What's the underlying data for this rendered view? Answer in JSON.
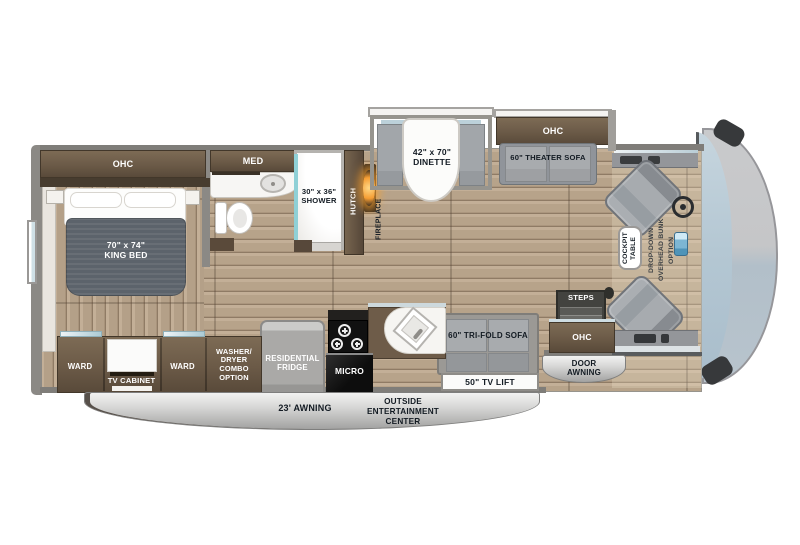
{
  "labels": {
    "bedroom_ohc": "OHC",
    "king_bed": "70\" x 74\"\nKING BED",
    "med": "MED",
    "shower": "30\" x 36\"\nSHOWER",
    "hutch": "HUTCH",
    "fireplace": "FIREPLACE",
    "dinette": "42\" x 70\"\nDINETTE",
    "living_ohc": "OHC",
    "theater_sofa": "60\" THEATER SOFA",
    "cockpit_table": "COCKPIT\nTABLE",
    "bunk_option": "DROP-DOWN\nOVERHEAD BUNK\nOPTION",
    "steps": "STEPS",
    "entry_ohc": "OHC",
    "door_awning": "DOOR\nAWNING",
    "trifold_sofa": "60\" TRI-FOLD SOFA",
    "tv_lift": "50\" TV LIFT",
    "kitchen_ohc": "OHC",
    "micro": "MICRO",
    "fridge": "RESIDENTIAL\nFRIDGE",
    "washer_dryer": "WASHER/\nDRYER\nCOMBO\nOPTION",
    "ward_left": "WARD",
    "tv_cabinet": "TV CABINET",
    "ward_right": "WARD",
    "awning": "23' AWNING",
    "outside_entertainment": "OUTSIDE\nENTERTAINMENT\nCENTER"
  },
  "colors": {
    "floor_wood": "#b7a38a",
    "cabinet_brown": "#6b5a47",
    "wall_gray": "#7f7d79",
    "sofa_gray": "#a2a6aa",
    "mattress_gray": "#5c636b",
    "windshield_blue": "#b3c6d2",
    "fireplace_orange": "#f59d33",
    "shower_glass_teal": "#8fd0d6",
    "banner_gray": "#c6c6c5"
  }
}
